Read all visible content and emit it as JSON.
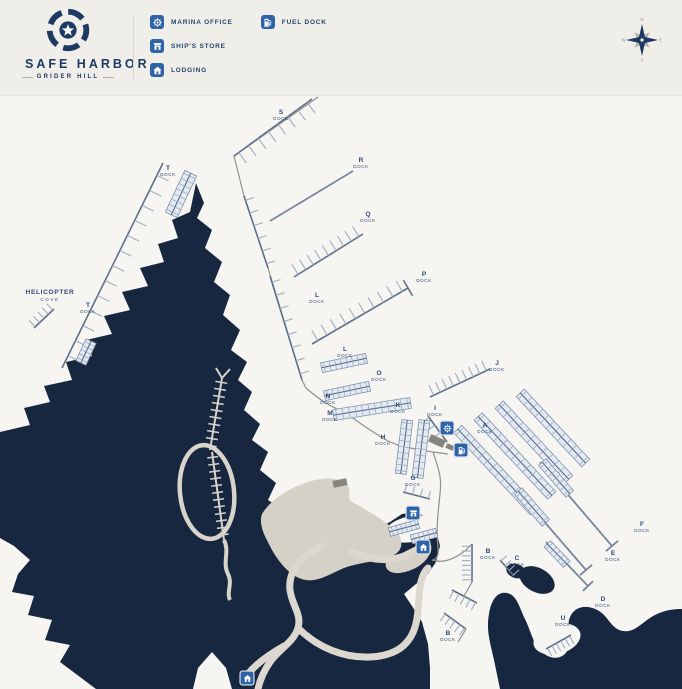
{
  "header": {
    "brand": {
      "name": "SAFE HARBOR",
      "location": "GRIDER HILL"
    },
    "legend": {
      "columns": [
        [
          {
            "id": "marina-office",
            "label": "MARINA OFFICE"
          },
          {
            "id": "ships-store",
            "label": "SHIP'S STORE"
          },
          {
            "id": "lodging",
            "label": "LODGING"
          }
        ],
        [
          {
            "id": "fuel-dock",
            "label": "FUEL DOCK"
          }
        ]
      ]
    },
    "compass": {
      "points": [
        "N",
        "E",
        "S",
        "W"
      ]
    }
  },
  "map": {
    "area_label": {
      "line1": "HELICOPTER",
      "line2": "COVE"
    },
    "dock_word": "DOCK",
    "dock_labels": [
      {
        "letter": "S",
        "x": 281,
        "y": 109
      },
      {
        "letter": "T",
        "x": 168,
        "y": 165
      },
      {
        "letter": "R",
        "x": 361,
        "y": 157
      },
      {
        "letter": "Q",
        "x": 368,
        "y": 211
      },
      {
        "letter": "P",
        "x": 424,
        "y": 271
      },
      {
        "letter": "L",
        "x": 317,
        "y": 292
      },
      {
        "letter": "T",
        "x": 88,
        "y": 302
      },
      {
        "letter": "L",
        "x": 345,
        "y": 346
      },
      {
        "letter": "J",
        "x": 497,
        "y": 360
      },
      {
        "letter": "O",
        "x": 379,
        "y": 370
      },
      {
        "letter": "N",
        "x": 328,
        "y": 393
      },
      {
        "letter": "K",
        "x": 398,
        "y": 402
      },
      {
        "letter": "I",
        "x": 435,
        "y": 405
      },
      {
        "letter": "M",
        "x": 330,
        "y": 410
      },
      {
        "letter": "A",
        "x": 485,
        "y": 422
      },
      {
        "letter": "H",
        "x": 383,
        "y": 434
      },
      {
        "letter": "G",
        "x": 413,
        "y": 475
      },
      {
        "letter": "F",
        "x": 642,
        "y": 521
      },
      {
        "letter": "B",
        "x": 488,
        "y": 548
      },
      {
        "letter": "C",
        "x": 517,
        "y": 555
      },
      {
        "letter": "E",
        "x": 613,
        "y": 550
      },
      {
        "letter": "D",
        "x": 603,
        "y": 596
      },
      {
        "letter": "U",
        "x": 563,
        "y": 615
      },
      {
        "letter": "B",
        "x": 448,
        "y": 630
      }
    ],
    "markers": [
      {
        "type": "marina-office",
        "x": 447,
        "y": 428
      },
      {
        "type": "fuel-dock",
        "x": 461,
        "y": 450
      },
      {
        "type": "ships-store",
        "x": 413,
        "y": 513
      },
      {
        "type": "lodging",
        "x": 423,
        "y": 547
      },
      {
        "type": "lodging",
        "x": 247,
        "y": 678
      }
    ],
    "colors": {
      "land": "#17273f",
      "water": "#f7f5f1",
      "header_bg": "#f0eee9",
      "accent_blue": "#2e63a8",
      "brand_navy": "#1e3a63",
      "covered_slip_fill": "#e4eaf3",
      "dock_line": "#9fadc0",
      "road_light": "#dcd8d0",
      "shore_tan": "#d6d1c7",
      "compass_gold": "#b8ad92"
    }
  }
}
